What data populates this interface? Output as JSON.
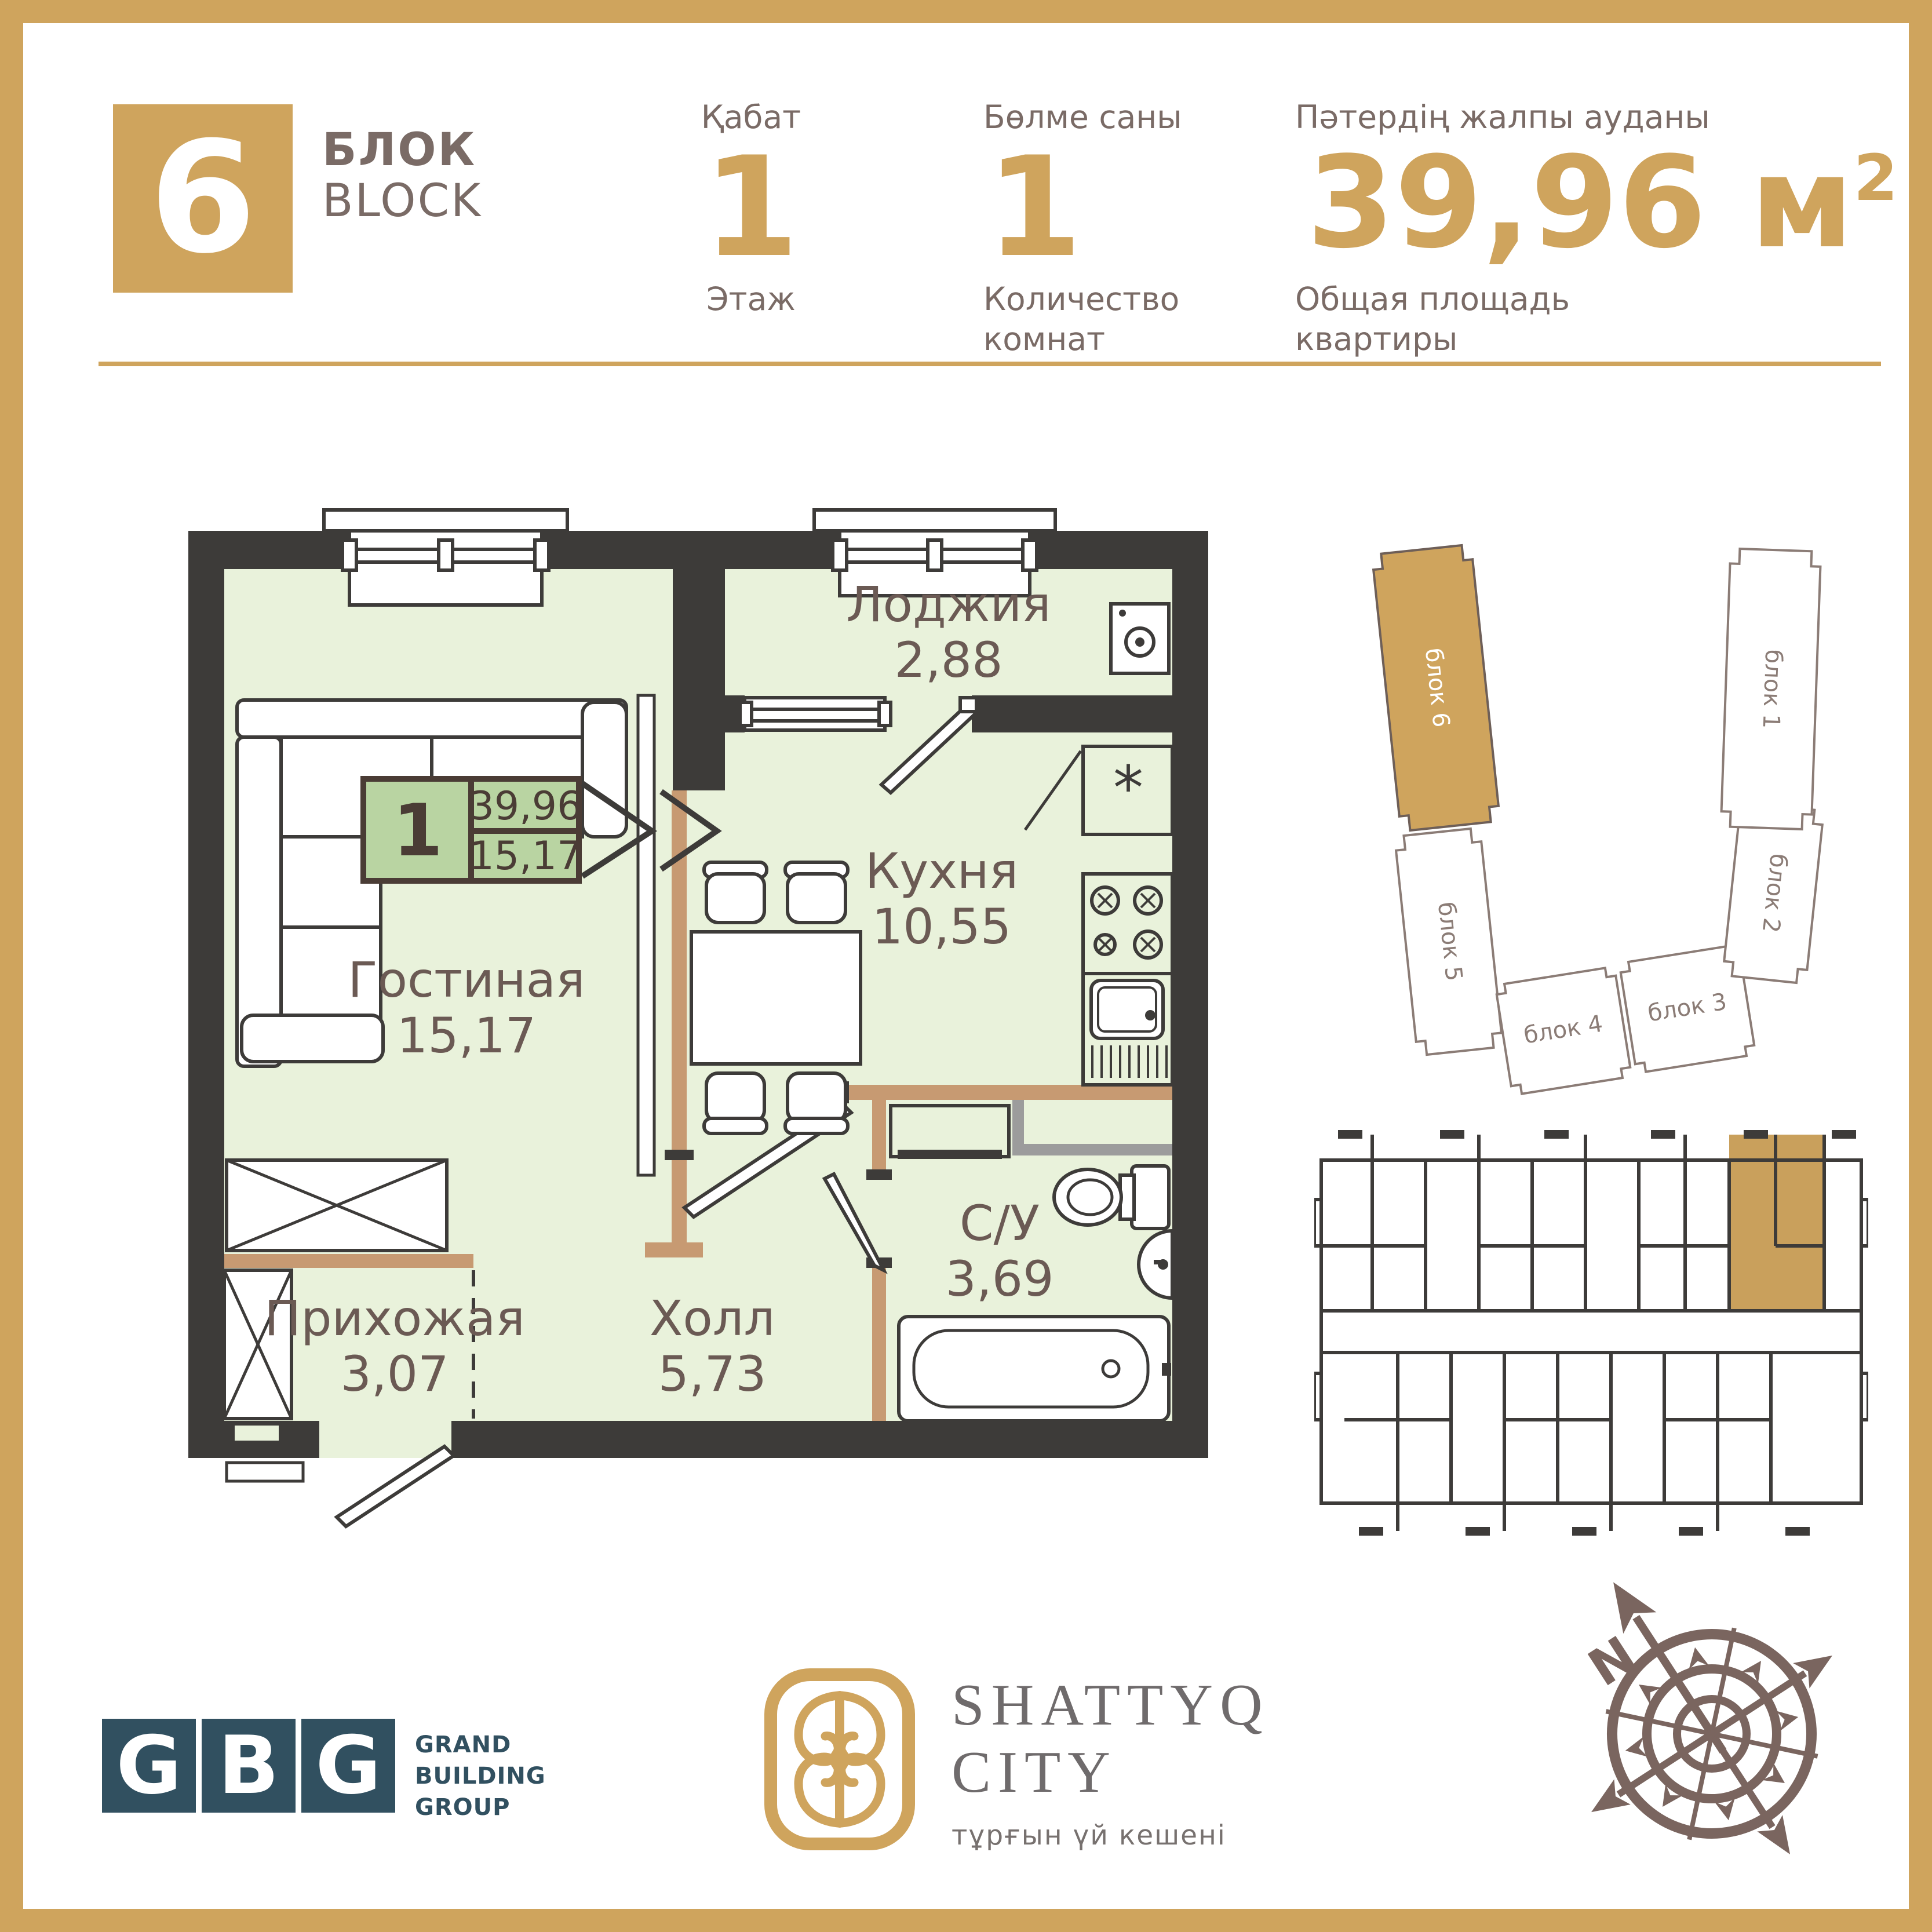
{
  "colors": {
    "accent_gold": "#cfa45d",
    "header_text": "#7a6b66",
    "wall_dark": "#3d3b39",
    "floor_green": "#e9f2db",
    "info_green": "#b9d4a2",
    "wood_tan": "#c79a72",
    "gbg_teal": "#315060",
    "compass_brown": "#7a655f"
  },
  "header": {
    "block_number": "6",
    "block_label_top": "БЛОК",
    "block_label_bottom": "BLOCK",
    "floor": {
      "label_top": "Қабат",
      "value": "1",
      "label_bottom": "Этаж"
    },
    "rooms": {
      "label_top": "Бөлме саны",
      "value": "1",
      "label_bottom": "Количество комнат"
    },
    "area": {
      "label_top": "Пәтердің жалпы ауданы",
      "value": "39,96 м",
      "sup": "2",
      "label_bottom": "Общая площадь квартиры"
    }
  },
  "plan": {
    "unit": {
      "rooms": "1",
      "total_area": "39,96",
      "living_area": "15,17"
    },
    "symbols": {
      "fridge": "*"
    },
    "rooms": {
      "loggia": {
        "name": "Лоджия",
        "area": "2,88"
      },
      "kitchen": {
        "name": "Кухня",
        "area": "10,55"
      },
      "living": {
        "name": "Гостиная",
        "area": "15,17"
      },
      "hallway": {
        "name": "Прихожая",
        "area": "3,07"
      },
      "hall": {
        "name": "Холл",
        "area": "5,73"
      },
      "bathroom": {
        "name": "С/У",
        "area": "3,69"
      }
    }
  },
  "siteplan": {
    "blocks": {
      "b6": "блок 6",
      "b5": "блок 5",
      "b4": "блок 4",
      "b3": "блок 3",
      "b2": "блок 2",
      "b1": "блок 1"
    }
  },
  "compass": {
    "north": "N"
  },
  "footer": {
    "gbg": {
      "l1": "G",
      "l2": "B",
      "l3": "G",
      "line1": "GRAND",
      "line2": "BUILDING",
      "line3": "GROUP"
    },
    "shattyq": {
      "line1": "SHATTYQ",
      "line2": "CITY",
      "subtitle": "тұрғын үй кешені"
    }
  }
}
